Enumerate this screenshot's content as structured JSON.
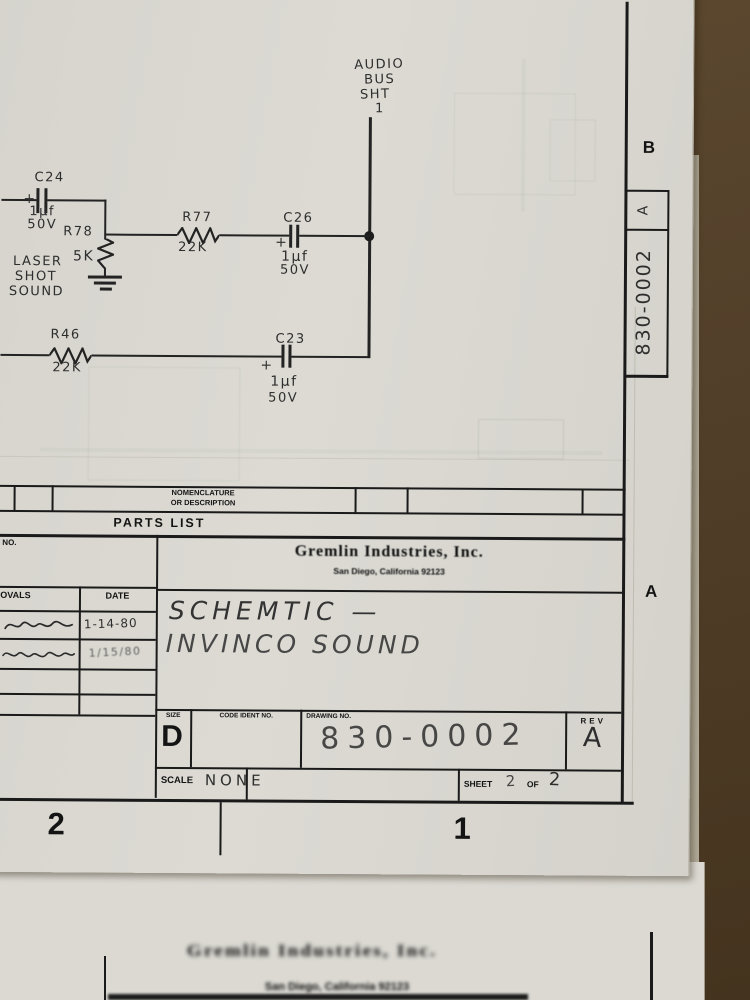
{
  "schematic": {
    "bus_label": [
      "AUDIO",
      "BUS",
      "SHT",
      "1"
    ],
    "c24": {
      "ref": "C24",
      "plus": "+",
      "value": "1µf",
      "voltage": "50V"
    },
    "r78": {
      "ref": "R78",
      "value": "5K"
    },
    "r77": {
      "ref": "R77",
      "value": "22K"
    },
    "c26": {
      "ref": "C26",
      "plus": "+",
      "value": "1µf",
      "voltage": "50V"
    },
    "r46": {
      "ref": "R46",
      "value": "22K"
    },
    "c23": {
      "ref": "C23",
      "plus": "+",
      "value": "1µf",
      "voltage": "50V"
    },
    "signal_label": [
      "LASER",
      "SHOT",
      "SOUND"
    ]
  },
  "parts_list": {
    "column_header_line1": "NOMENCLATURE",
    "column_header_line2": "OR DESCRIPTION",
    "band_title": "PARTS LIST",
    "no_label": "NO."
  },
  "title_block": {
    "company": "Gremlin Industries, Inc.",
    "address": "San Diego, California 92123",
    "approvals_label": "APPROVALS",
    "date_label": "DATE",
    "approval_dates": [
      "1-14-80",
      "1/15/80"
    ],
    "title_line1": "SCHEMTIC —",
    "title_line2": "INVINCO SOUND",
    "size_label": "SIZE",
    "size_value": "D",
    "code_ident_label": "CODE IDENT NO.",
    "drawing_no_label": "DRAWING NO.",
    "drawing_no_value": "830-0002",
    "rev_label": "REV",
    "rev_value": "A",
    "scale_label": "SCALE",
    "scale_value": "NONE",
    "sheet_label": "SHEET",
    "sheet_value": "2",
    "of_label": "OF",
    "sheet_total": "2"
  },
  "margin": {
    "zone_row_b": "B",
    "zone_row_a": "A",
    "zone_col_2": "2",
    "zone_col_1": "1",
    "edge_drawing_no": "830-0002",
    "edge_rev": "A"
  },
  "under_sheet": {
    "company": "Gremlin Industries, Inc.",
    "address": "San Diego, California 92123"
  },
  "colors": {
    "ink": "#232323",
    "paper": "#dad8d1",
    "desk": "#54402a"
  }
}
